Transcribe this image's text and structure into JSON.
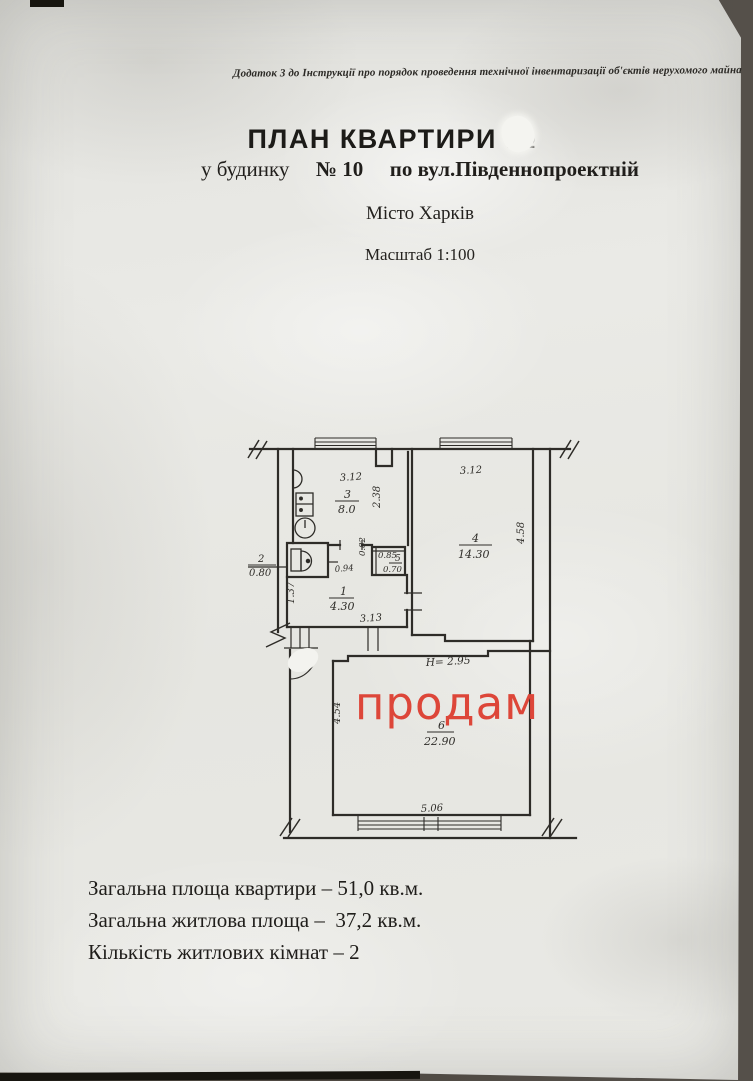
{
  "page": {
    "header_note": "Додаток 3 до Інструкції про порядок проведення технічної інвентаризації об'єктів нерухомого майна",
    "title": "ПЛАН КВАРТИРИ №",
    "subtitle_prefix": "у будинку",
    "subtitle_house_no": "№ 10",
    "subtitle_street": "по вул.Південнопроектній",
    "city": "Місто Харків",
    "scale": "Масштаб 1:100",
    "watermark": "продам",
    "summary": [
      "Загальна площа квартири – 51,0 кв.м.",
      "Загальна житлова площа –  37,2 кв.м.",
      "Кількість житлових кімнат – 2"
    ]
  },
  "colors": {
    "ink": "#2e2c28",
    "watermark_red": "#dd4639",
    "paper": "#e8e8e3"
  },
  "plan": {
    "height_note": "Н= 2.95",
    "rooms": {
      "hall": {
        "number": "1",
        "area": "4.30"
      },
      "wc": {
        "number": "2",
        "area": "0.80"
      },
      "kitchen": {
        "number": "3",
        "area": "8.0"
      },
      "room4": {
        "number": "4",
        "area": "14.30"
      },
      "closet": {
        "number": "5",
        "area": "0.70"
      },
      "room6": {
        "number": "6",
        "area": "22.90"
      }
    },
    "dims": {
      "kitchen_width": "3.12",
      "kitchen_depth": "2.38",
      "room4_width": "3.12",
      "room4_depth": "4.58",
      "hall_width": "3.13",
      "hall_depth": "1.37",
      "wc_passage": "0.94",
      "closet_width": "0.85",
      "closet_depth": "0.82",
      "room6_width": "5.06",
      "room6_depth": "4.54"
    }
  }
}
